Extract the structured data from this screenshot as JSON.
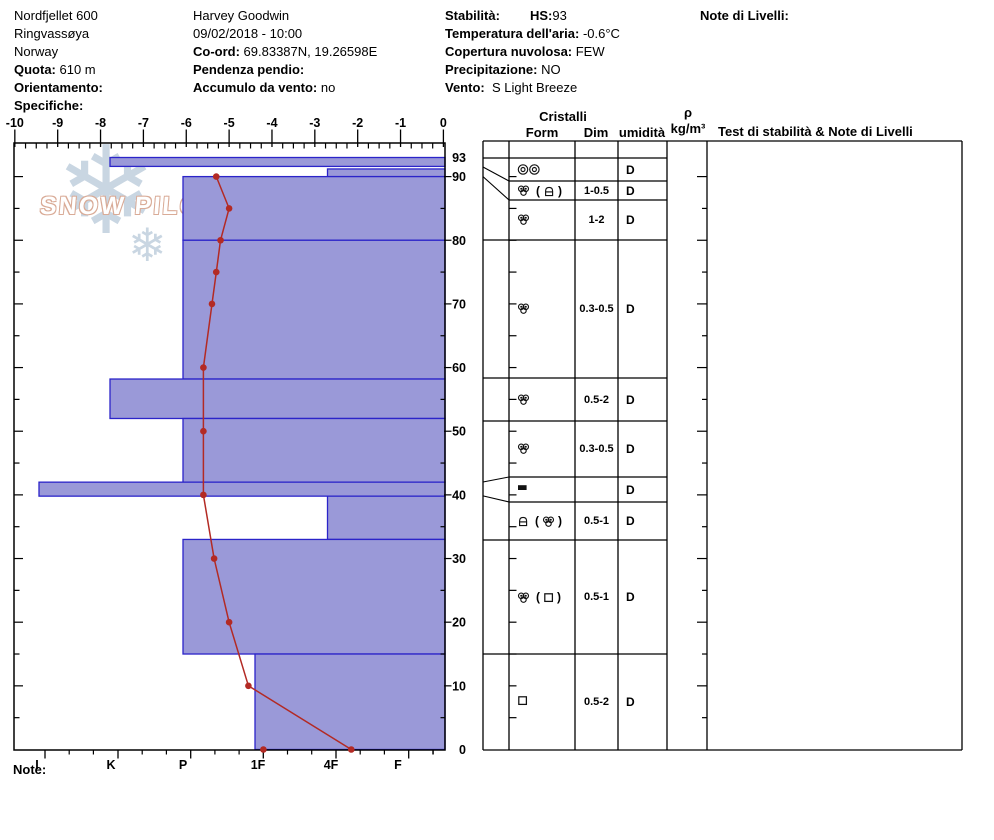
{
  "header": {
    "col1": [
      {
        "label": "",
        "value": "Nordfjellet 600"
      },
      {
        "label": "",
        "value": "Ringvassøya"
      },
      {
        "label": "",
        "value": "Norway"
      },
      {
        "label": "Quota:",
        "value": " 610 m"
      },
      {
        "label": "Orientamento:",
        "value": ""
      },
      {
        "label": "Specifiche:",
        "value": ""
      }
    ],
    "col2": [
      {
        "label": "",
        "value": "Harvey Goodwin"
      },
      {
        "label": "",
        "value": "09/02/2018 - 10:00"
      },
      {
        "label": "Co-ord:",
        "value": " 69.83387N, 19.26598E"
      },
      {
        "label": "Pendenza pendio:",
        "value": ""
      },
      {
        "label": "Accumulo da vento:",
        "value": " no"
      }
    ],
    "col3": [
      {
        "label": "Stabilità:",
        "value": ""
      },
      {
        "label": "Temperatura dell'aria:",
        "value": " -0.6°C"
      },
      {
        "label": "Copertura nuvolosa:",
        "value": " FEW"
      },
      {
        "label": "Precipitazione:",
        "value": " NO"
      },
      {
        "label": "Vento:",
        "value": "  S Light Breeze"
      }
    ],
    "hs_label": "HS:",
    "hs_value": "93",
    "note_livelli_label": "Note di Livelli:"
  },
  "watermark": {
    "text": "SNOW PILOT",
    "suffix": "7",
    "flake": "❄"
  },
  "note_label": "Note:",
  "chart_data": {
    "type": "bar",
    "orientation": "horizontal",
    "description": "Snowpack hand-hardness profile (bars) with snow temperature curve (red line)",
    "temp_axis": {
      "position": "top",
      "min": -10,
      "max": 0,
      "ticks": [
        -10,
        -9,
        -8,
        -7,
        -6,
        -5,
        -4,
        -3,
        -2,
        -1,
        0
      ]
    },
    "hardness_axis": {
      "position": "bottom",
      "categories": [
        "I",
        "K",
        "P",
        "1F",
        "4F",
        "F"
      ]
    },
    "depth_axis": {
      "position": "right",
      "ticks": [
        93,
        90,
        80,
        70,
        60,
        50,
        40,
        30,
        20,
        10,
        0
      ],
      "max_depth_cm": 93
    },
    "layers": [
      {
        "from_cm": 93,
        "to_cm": 91.6,
        "hardness": "K"
      },
      {
        "from_cm": 91.2,
        "to_cm": 90,
        "hardness": "4F"
      },
      {
        "from_cm": 90,
        "to_cm": 80,
        "hardness": "P"
      },
      {
        "from_cm": 80,
        "to_cm": 58.2,
        "hardness": "P"
      },
      {
        "from_cm": 58.2,
        "to_cm": 52,
        "hardness": "K"
      },
      {
        "from_cm": 52,
        "to_cm": 42,
        "hardness": "P"
      },
      {
        "from_cm": 42,
        "to_cm": 39.8,
        "hardness": "I"
      },
      {
        "from_cm": 39.8,
        "to_cm": 33,
        "hardness": "4F"
      },
      {
        "from_cm": 33,
        "to_cm": 15,
        "hardness": "P"
      },
      {
        "from_cm": 15,
        "to_cm": 0,
        "hardness": "1F"
      }
    ],
    "temperature_series": {
      "name": "Snow temperature °C",
      "points": [
        {
          "depth_cm": 90,
          "temp_c": -5.3
        },
        {
          "depth_cm": 85,
          "temp_c": -5.0
        },
        {
          "depth_cm": 80,
          "temp_c": -5.2
        },
        {
          "depth_cm": 75,
          "temp_c": -5.3
        },
        {
          "depth_cm": 70,
          "temp_c": -5.4
        },
        {
          "depth_cm": 60,
          "temp_c": -5.6
        },
        {
          "depth_cm": 50,
          "temp_c": -5.6
        },
        {
          "depth_cm": 40,
          "temp_c": -5.6
        },
        {
          "depth_cm": 30,
          "temp_c": -5.35
        },
        {
          "depth_cm": 20,
          "temp_c": -5.0
        },
        {
          "depth_cm": 10,
          "temp_c": -4.55
        },
        {
          "depth_cm": 0,
          "temp_c": -2.15
        }
      ],
      "extra_markers": [
        {
          "depth_cm": 0,
          "temp_c": -4.2
        }
      ]
    },
    "colors": {
      "bar_fill": "#9a99d8",
      "bar_stroke": "#2b24c9",
      "temp_line": "#b32a24",
      "frame": "#000000"
    }
  },
  "table": {
    "headers": {
      "cristalli": "Cristalli",
      "form": "Form",
      "dim": "Dim",
      "umidita": "umidità",
      "rho": "ρ",
      "rho_unit": "kg/m³",
      "test": "Test di stabilità & Note di Livelli"
    },
    "rows": [
      {
        "form_primary": "mfcr2",
        "form_secondary": null,
        "dim": "",
        "wet": "D"
      },
      {
        "form_primary": "cluster",
        "form_secondary": "lock",
        "dim": "1-0.5",
        "wet": "D"
      },
      {
        "form_primary": "cluster",
        "form_secondary": null,
        "dim": "1-2",
        "wet": "D"
      },
      {
        "form_primary": "cluster",
        "form_secondary": null,
        "dim": "0.3-0.5",
        "wet": "D"
      },
      {
        "form_primary": "cluster",
        "form_secondary": null,
        "dim": "0.5-2",
        "wet": "D"
      },
      {
        "form_primary": "cluster",
        "form_secondary": null,
        "dim": "0.3-0.5",
        "wet": "D"
      },
      {
        "form_primary": "ice",
        "form_secondary": null,
        "dim": "",
        "wet": "D"
      },
      {
        "form_primary": "lock",
        "form_secondary": "cluster",
        "dim": "0.5-1",
        "wet": "D"
      },
      {
        "form_primary": "cluster",
        "form_secondary": "square",
        "dim": "0.5-1",
        "wet": "D"
      },
      {
        "form_primary": "square",
        "form_secondary": null,
        "dim": "0.5-2",
        "wet": "D"
      }
    ]
  }
}
